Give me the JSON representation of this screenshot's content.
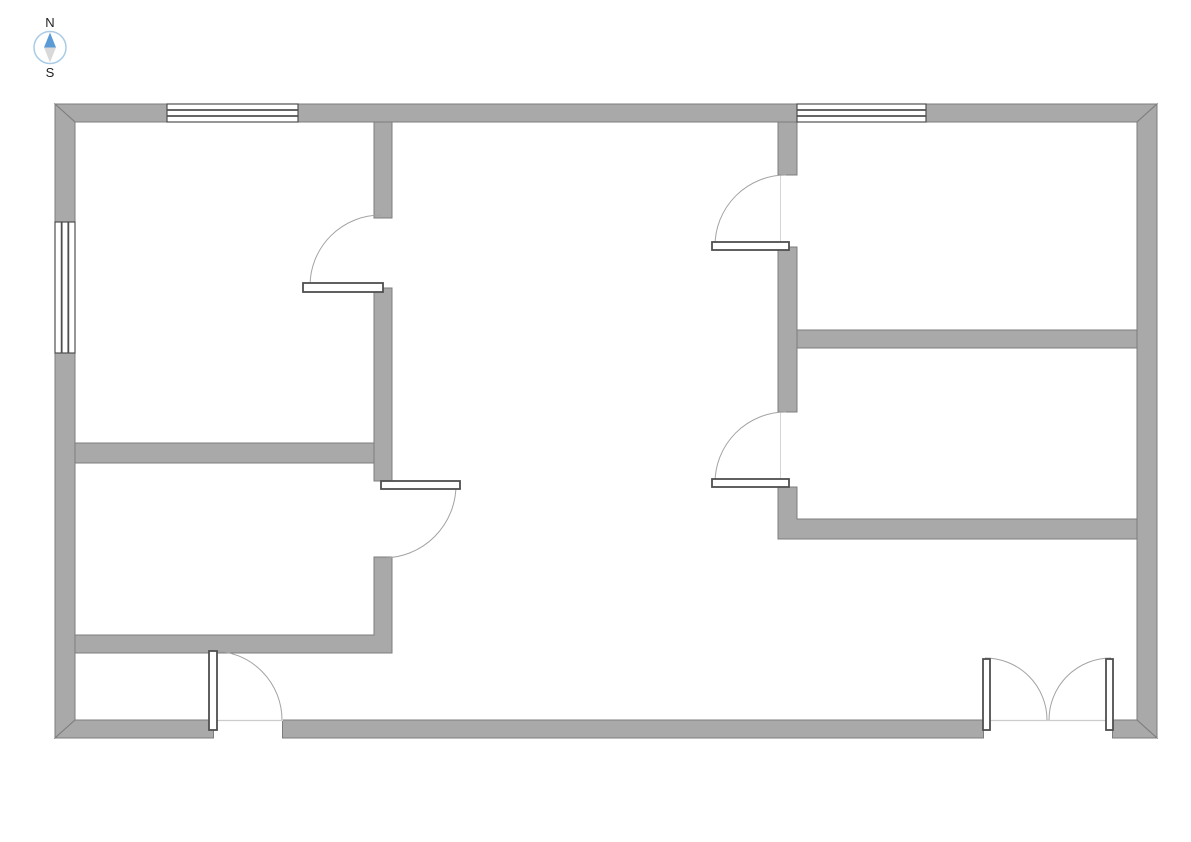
{
  "compass": {
    "north_label": "N",
    "south_label": "S",
    "label_color": "#222222",
    "ring_color": "#aacbe5",
    "needle_north_color": "#5b9bd5",
    "needle_south_color": "#d9d9d9"
  },
  "palette": {
    "background": "#ffffff",
    "wall_fill": "#a9a9a9",
    "wall_stroke": "#7d7d7d",
    "window_fill": "#ffffff",
    "window_stroke": "#4f4f4f",
    "door_leaf_fill": "#ffffff",
    "door_leaf_stroke": "#4f4f4f",
    "door_arc_stroke": "#a3a3a3",
    "door_frame_stroke": "#d5d5d5",
    "threshold_stroke": "#cccccc"
  },
  "floor_plan": {
    "walls": [
      {
        "name": "exterior-top",
        "points": [
          [
            55,
            104
          ],
          [
            1157,
            104
          ],
          [
            1137,
            122
          ],
          [
            75,
            122
          ]
        ]
      },
      {
        "name": "exterior-left",
        "points": [
          [
            55,
            104
          ],
          [
            75,
            122
          ],
          [
            75,
            720
          ],
          [
            55,
            738
          ]
        ]
      },
      {
        "name": "exterior-right",
        "points": [
          [
            1157,
            104
          ],
          [
            1137,
            122
          ],
          [
            1137,
            720
          ],
          [
            1157,
            738
          ]
        ]
      },
      {
        "name": "exterior-bottom",
        "points": [
          [
            55,
            738
          ],
          [
            75,
            720
          ],
          [
            1137,
            720
          ],
          [
            1157,
            738
          ]
        ]
      },
      {
        "name": "interior-middle-upper",
        "points": [
          [
            374,
            122
          ],
          [
            392,
            122
          ],
          [
            392,
            218
          ],
          [
            374,
            218
          ]
        ]
      },
      {
        "name": "interior-middle-center",
        "points": [
          [
            374,
            288
          ],
          [
            392,
            288
          ],
          [
            392,
            481
          ],
          [
            374,
            481
          ]
        ]
      },
      {
        "name": "interior-middle-lower",
        "points": [
          [
            374,
            557
          ],
          [
            392,
            557
          ],
          [
            392,
            653
          ],
          [
            75,
            653
          ],
          [
            75,
            635
          ],
          [
            374,
            635
          ]
        ]
      },
      {
        "name": "interior-left-divider",
        "points": [
          [
            75,
            443
          ],
          [
            374,
            443
          ],
          [
            374,
            463
          ],
          [
            75,
            463
          ]
        ]
      },
      {
        "name": "interior-right-upper",
        "points": [
          [
            778,
            122
          ],
          [
            797,
            122
          ],
          [
            797,
            175
          ],
          [
            778,
            175
          ]
        ]
      },
      {
        "name": "interior-right-middle",
        "points": [
          [
            778,
            247
          ],
          [
            797,
            247
          ],
          [
            797,
            412
          ],
          [
            778,
            412
          ]
        ]
      },
      {
        "name": "interior-right-lower",
        "points": [
          [
            778,
            487
          ],
          [
            797,
            487
          ],
          [
            797,
            519
          ],
          [
            1137,
            519
          ],
          [
            1137,
            539
          ],
          [
            778,
            539
          ]
        ]
      },
      {
        "name": "interior-right-divider",
        "points": [
          [
            797,
            330
          ],
          [
            1137,
            330
          ],
          [
            1137,
            348
          ],
          [
            797,
            348
          ]
        ]
      }
    ],
    "door_openings": [
      [
        213,
        719,
        70,
        20
      ],
      [
        983,
        719,
        130,
        20
      ]
    ],
    "jamb_lines": [
      [
        213.5,
        720,
        213.5,
        738.5
      ],
      [
        282.5,
        720,
        282.5,
        738.5
      ],
      [
        983.5,
        720,
        983.5,
        738.5
      ],
      [
        1112.5,
        720,
        1112.5,
        738.5
      ]
    ],
    "threshold_lines": [
      [
        213,
        720.5,
        283,
        720.5
      ],
      [
        983,
        720.5,
        1113,
        720.5
      ]
    ],
    "windows": [
      {
        "name": "window-top-left",
        "rect": [
          167,
          104,
          131,
          18
        ],
        "orient": "h"
      },
      {
        "name": "window-top-right",
        "rect": [
          797,
          104,
          129,
          18
        ],
        "orient": "h"
      },
      {
        "name": "window-left",
        "rect": [
          55,
          222,
          20,
          131
        ],
        "orient": "v"
      }
    ],
    "doors": [
      {
        "name": "door-top-left-room",
        "leaf": [
          303,
          283,
          80,
          9
        ],
        "arc": "M 310 286 A 71 71 0 0 1 381 215"
      },
      {
        "name": "door-bottom-left-room",
        "leaf": [
          381,
          481,
          79,
          8
        ],
        "arc": "M 456 485 A 73 73 0 0 1 383 558"
      },
      {
        "name": "door-top-right-room",
        "leaf": [
          712,
          242,
          77,
          8
        ],
        "arc": "M 715 246 A 71 71 0 0 1 786 175",
        "frame": [
          780.5,
          175,
          780.5,
          242
        ]
      },
      {
        "name": "door-middle-right-room",
        "leaf": [
          712,
          479,
          77,
          8
        ],
        "arc": "M 715 483 A 71 71 0 0 1 786 412",
        "frame": [
          780.5,
          412,
          780.5,
          479
        ]
      },
      {
        "name": "entry-door-left",
        "leaf": [
          209,
          651,
          8,
          79
        ],
        "arc": "M 213 651 A 69 69 0 0 1 282 720"
      },
      {
        "name": "entry-double-door-left-leaf",
        "leaf": [
          983,
          659,
          7,
          71
        ],
        "arc": "M 985 658 A 62 62 0 0 1 1047 720"
      },
      {
        "name": "entry-double-door-right-leaf",
        "leaf": [
          1106,
          659,
          7,
          71
        ],
        "arc": "M 1111 658 A 62 62 0 0 0 1049 720"
      }
    ]
  }
}
